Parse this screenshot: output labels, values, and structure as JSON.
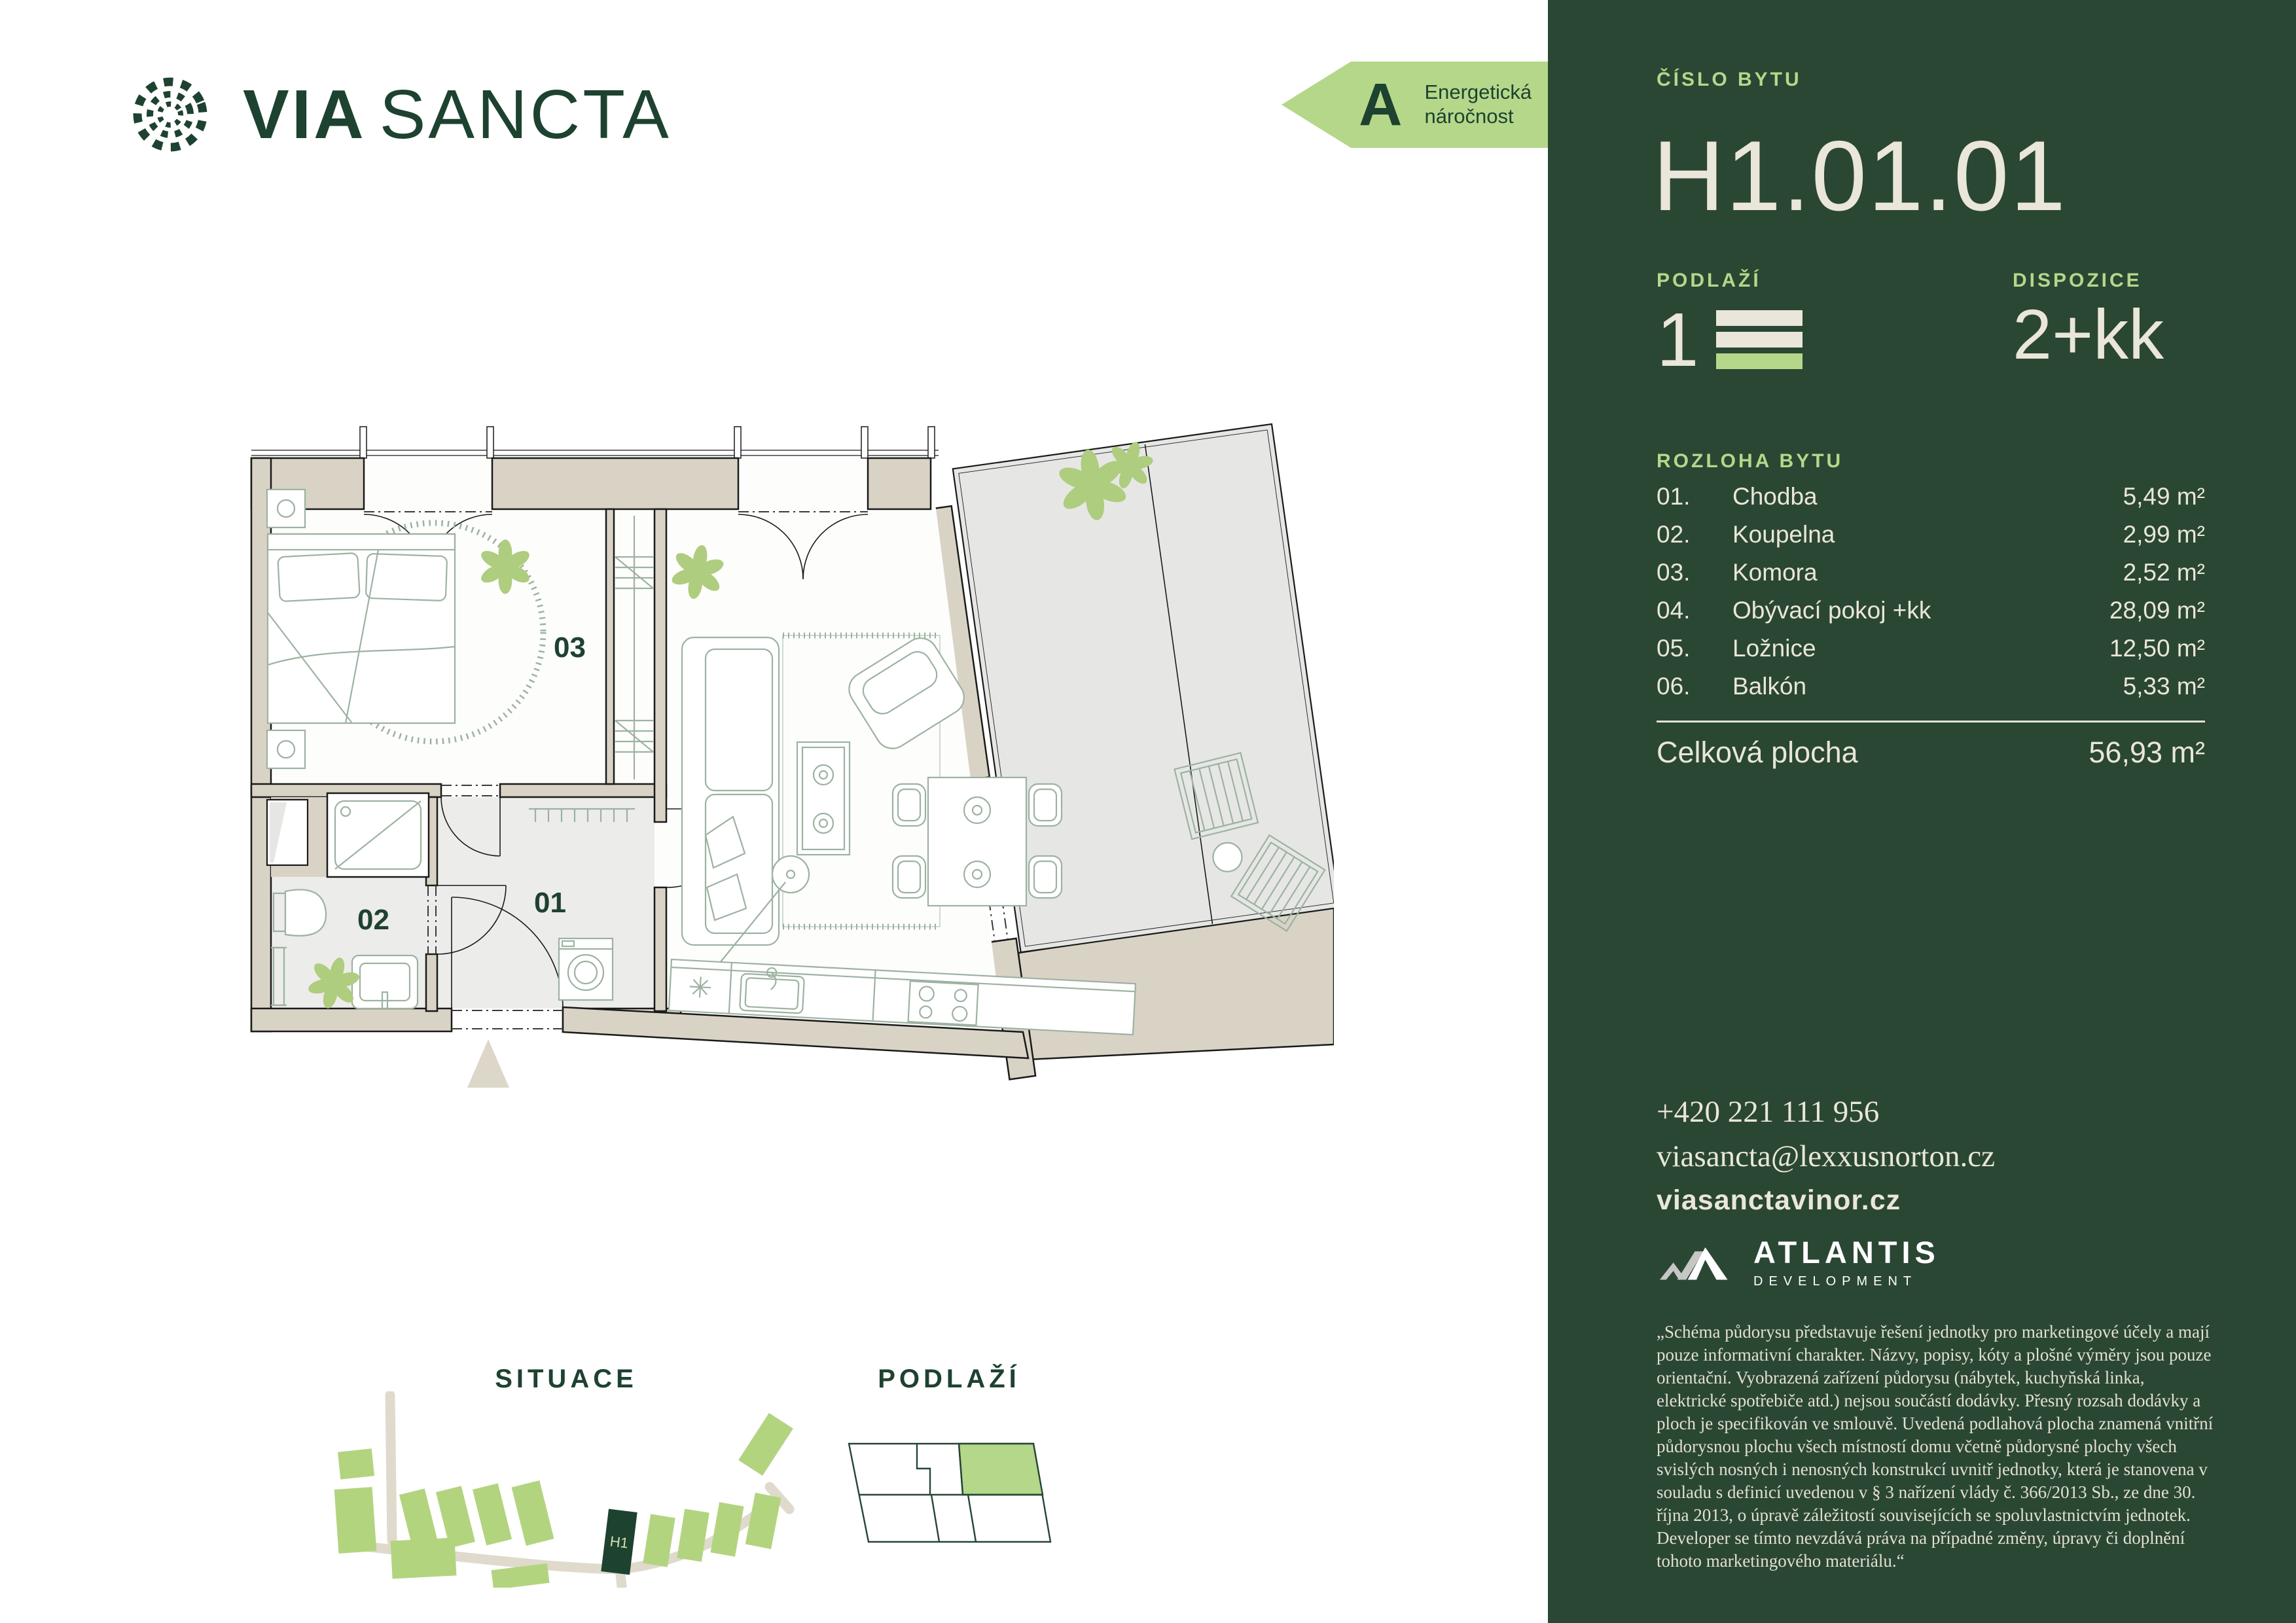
{
  "brand": {
    "logo_word1": "VIA",
    "logo_word2": "SANCTA"
  },
  "energy": {
    "rating": "A",
    "line1": "Energetická",
    "line2": "náročnost"
  },
  "panel": {
    "unit_label": "ČÍSLO BYTU",
    "unit_number": "H1.01.01",
    "floor_label": "PODLAŽÍ",
    "floor_value": "1",
    "disposition_label": "DISPOZICE",
    "disposition_value": "2+kk",
    "area_section_label": "ROZLOHA BYTU",
    "rooms": [
      {
        "num": "01.",
        "name": "Chodba",
        "area": "5,49 m²"
      },
      {
        "num": "02.",
        "name": "Koupelna",
        "area": "2,99 m²"
      },
      {
        "num": "03.",
        "name": "Komora",
        "area": "2,52 m²"
      },
      {
        "num": "04.",
        "name": "Obývací pokoj +kk",
        "area": "28,09 m²"
      },
      {
        "num": "05.",
        "name": "Ložnice",
        "area": "12,50 m²"
      },
      {
        "num": "06.",
        "name": "Balkón",
        "area": "5,33 m²"
      }
    ],
    "total_label": "Celková plocha",
    "total_area": "56,93 m²",
    "contact": {
      "phone": "+420 221 111 956",
      "email": "viasancta@lexxusnorton.cz",
      "web": "viasanctavinor.cz"
    },
    "developer": {
      "name": "ATLANTIS",
      "subtitle": "DEVELOPMENT"
    },
    "disclaimer": "„Schéma půdorysu představuje řešení jednotky pro marketingové účely a mají pouze informativní charakter. Názvy, popisy, kóty a plošné výměry jsou pouze orientační. Vyobrazená zařízení půdorysu (nábytek, kuchyňská linka, elektrické spotřebiče atd.) nejsou součástí dodávky. Přesný rozsah dodávky a ploch je specifikován ve smlouvě. Uvedená podlahová plocha znamená vnitřní půdorysnou plochu všech místností domu včetně půdorysné plochy všech svislých nosných i nenosných konstrukcí uvnitř jednotky, která je stanovena v souladu s definicí uvedenou v § 3 nařízení vlády č. 366/2013 Sb., ze dne 30. října 2013, o úpravě záležitostí souvisejících se spoluvlastnictvím jednotek. Developer se tímto nevzdává práva na případné změny, úpravy či doplnění tohoto marketingového materiálu.“"
  },
  "floorplan": {
    "room_labels": {
      "hall": "01",
      "bathroom": "02",
      "storage": "03"
    }
  },
  "situace": {
    "title": "SITUACE",
    "building_tag": "H1"
  },
  "podlazi_map": {
    "title": "PODLAŽÍ"
  },
  "colors": {
    "panel_green": "#2A4734",
    "accent_green": "#B5D78A",
    "cream": "#EAE6DA",
    "dark_green_text": "#1E4230",
    "wall_beige": "#D9D3C6"
  }
}
